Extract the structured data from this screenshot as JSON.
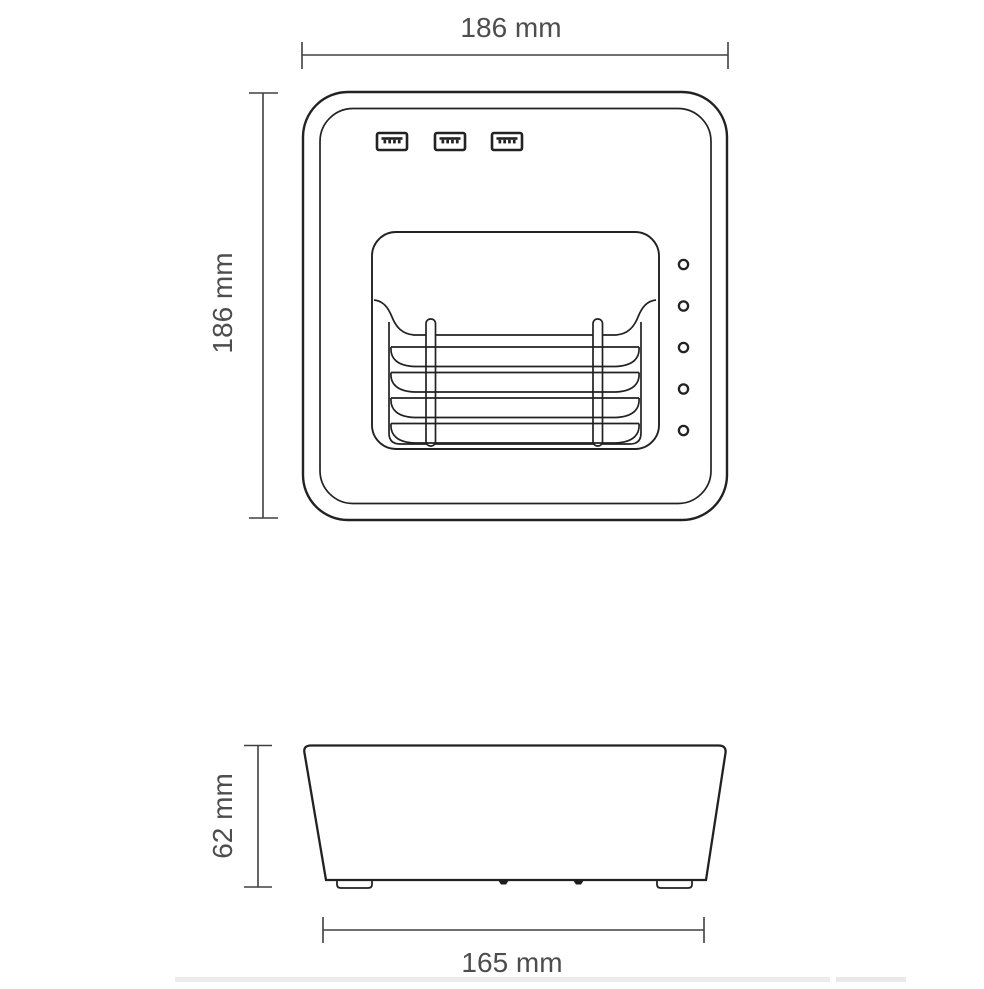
{
  "diagram": {
    "description": "technical-dimension-drawing-of-usb-charging-dock",
    "labels": {
      "top_width": "186 mm",
      "left_height": "186 mm",
      "front_height": "62 mm",
      "bottom_width": "165 mm"
    },
    "colors": {
      "line": "#222222",
      "dimension_line": "#404040",
      "text": "#4d4d4d",
      "background": "#ffffff"
    },
    "top_view": {
      "usb_port_count": 3,
      "led_count": 5,
      "slot_divider_count": 4
    },
    "front_view": {
      "foot_count": 2
    }
  }
}
